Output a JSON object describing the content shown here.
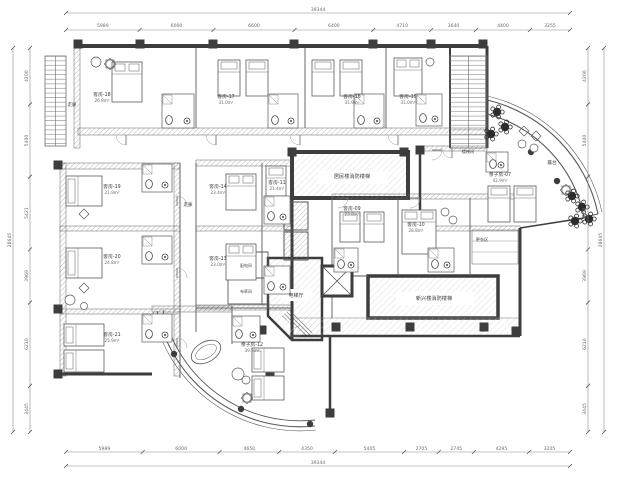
{
  "drawing": {
    "type": "hotel-guest-floor-plan",
    "dimensions": {
      "top": {
        "total": "39344",
        "segments": [
          "5989",
          "6000",
          "6600",
          "6400",
          "4710",
          "3640",
          "4400",
          "3255"
        ]
      },
      "bottom": {
        "total": "39344",
        "segments": [
          "5989",
          "6000",
          "4650",
          "4350",
          "5405",
          "2705",
          "2745",
          "4295",
          "3205"
        ]
      },
      "left": {
        "total": "28645",
        "segments": [
          "4200",
          "5400",
          "5421",
          "3969",
          "6210",
          "3445"
        ]
      },
      "right": {
        "total": "28645",
        "segments": [
          "4200",
          "5400",
          "5421",
          "3969",
          "6210",
          "3445"
        ]
      }
    },
    "rooms": [
      {
        "name": "客房-18",
        "area": "26.9m²",
        "x": 102,
        "y": 96
      },
      {
        "name": "客房-17",
        "area": "31.0m²",
        "x": 226,
        "y": 98
      },
      {
        "name": "客房-16",
        "area": "31.9m²",
        "x": 352,
        "y": 98
      },
      {
        "name": "客房-15",
        "area": "31.0m²",
        "x": 408,
        "y": 98
      },
      {
        "name": "客房-19",
        "area": "21.9m²",
        "x": 112,
        "y": 188
      },
      {
        "name": "客房-20",
        "area": "24.8m²",
        "x": 112,
        "y": 258
      },
      {
        "name": "客房-21",
        "area": "25.9m²",
        "x": 112,
        "y": 336
      },
      {
        "name": "客房-14",
        "area": "23.4m²",
        "x": 218,
        "y": 188
      },
      {
        "name": "客房-13",
        "area": "23.0m²",
        "x": 218,
        "y": 260
      },
      {
        "name": "客房-11",
        "area": "21.4m²",
        "x": 277,
        "y": 184
      },
      {
        "name": "亲子房-12",
        "area": "39.9m²",
        "x": 252,
        "y": 346
      },
      {
        "name": "客房-09",
        "area": "23.8m²",
        "x": 352,
        "y": 210
      },
      {
        "name": "客房-10",
        "area": "28.8m²",
        "x": 416,
        "y": 226
      },
      {
        "name": "亲子房-07",
        "area": "42.9m²",
        "x": 500,
        "y": 176
      }
    ],
    "spaces": [
      {
        "name": "走廊",
        "x": 72,
        "y": 106,
        "size": 4.4
      },
      {
        "name": "走廊",
        "x": 188,
        "y": 206,
        "size": 4.4
      },
      {
        "name": "楼梯间",
        "x": 468,
        "y": 153,
        "size": 4.2
      },
      {
        "name": "露台",
        "x": 552,
        "y": 164,
        "size": 4.6
      },
      {
        "name": "电梯厅",
        "x": 296,
        "y": 297,
        "size": 5
      },
      {
        "name": "居民楼消防楼梯",
        "x": 352,
        "y": 178,
        "size": 5.2
      },
      {
        "name": "新兴楼消防楼梯",
        "x": 434,
        "y": 300,
        "size": 5.2
      },
      {
        "name": "更衣区",
        "x": 482,
        "y": 241,
        "size": 4.2
      },
      {
        "name": "配电间",
        "x": 246,
        "y": 267,
        "size": 3.9
      },
      {
        "name": "布草间",
        "x": 246,
        "y": 293,
        "size": 3.9
      }
    ],
    "colors": {
      "wall": "#3d3d3d",
      "line": "#5a5a5a",
      "dim": "#6a6a6a",
      "hatch": "#9a9a9a"
    }
  }
}
